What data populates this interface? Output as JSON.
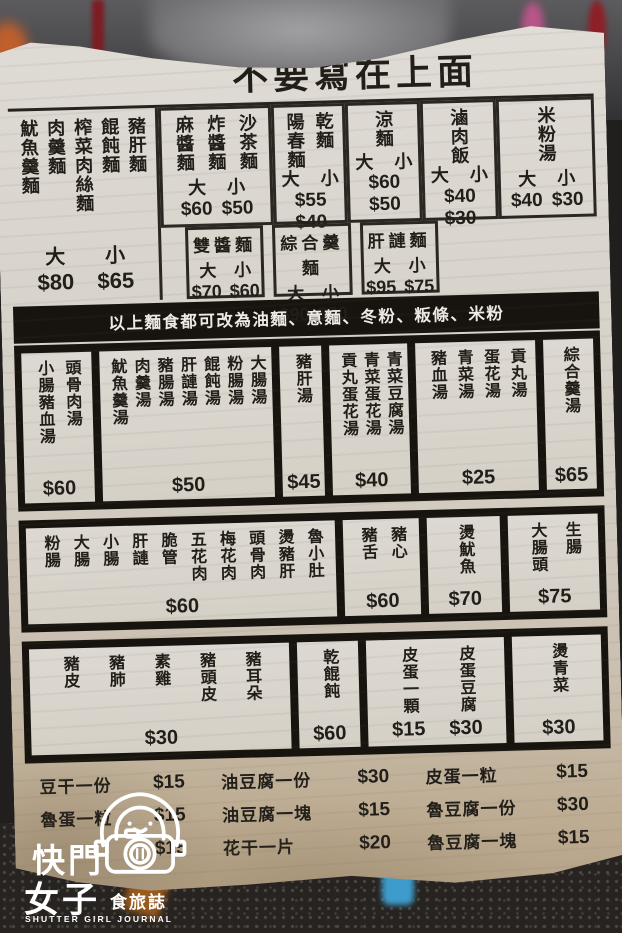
{
  "colors": {
    "paper": "#d7d2c9",
    "ink": "#211e19",
    "banner_bg": "#17130e",
    "watermark": "#ffffff"
  },
  "title": "不要寫在上面",
  "banner": "以上麵食都可改為油麵、意麵、冬粉、粄條、米粉",
  "noodles_left": {
    "items": [
      "魷魚羹麵",
      "肉羹麵",
      "榨菜肉絲麵",
      "餛飩麵",
      "豬肝麵"
    ],
    "size_large": "大",
    "price_large": "$80",
    "size_small": "小",
    "price_small": "$65"
  },
  "noodles_row1": [
    {
      "items": [
        "麻醬麵",
        "炸醬麵",
        "沙茶麵"
      ],
      "sizes": "大 小",
      "prices": "$60 $50"
    },
    {
      "items": [
        "陽春麵",
        "乾麵"
      ],
      "sizes": "大 小",
      "prices": "$55 $40"
    },
    {
      "items": [
        "涼麵"
      ],
      "sizes": "大 小",
      "prices": "$60 $50"
    },
    {
      "items": [
        "滷肉飯"
      ],
      "sizes": "大 小",
      "prices": "$40 $30"
    },
    {
      "items": [
        "米粉湯"
      ],
      "sizes": "大 小",
      "prices": "$40 $30"
    }
  ],
  "noodles_row2": [
    {
      "name": "雙醬麵",
      "sizes": "大 小",
      "prices": "$70 $60"
    },
    {
      "name": "綜合羹麵",
      "sizes": "大 小",
      "prices": "$90 $80"
    },
    {
      "name": "肝謰麵",
      "sizes": "大 小",
      "prices": "$95 $75"
    }
  ],
  "soups": [
    {
      "items": [
        "小腸豬血湯",
        "頭骨肉湯"
      ],
      "price": "$60"
    },
    {
      "items": [
        "魷魚羹湯",
        "肉羹湯",
        "豬腸湯",
        "肝謰湯",
        "餛飩湯",
        "粉腸湯",
        "大腸湯"
      ],
      "price": "$50"
    },
    {
      "items": [
        "豬肝湯"
      ],
      "price": "$45"
    },
    {
      "items": [
        "貢丸蛋花湯",
        "青菜蛋花湯",
        "青菜豆腐湯"
      ],
      "price": "$40"
    },
    {
      "items": [
        "豬血湯",
        "青菜湯",
        "蛋花湯",
        "貢丸湯"
      ],
      "price": "$25"
    },
    {
      "items": [
        "綜合羹湯"
      ],
      "price": "$65"
    }
  ],
  "braised": [
    {
      "items": [
        "粉腸",
        "大腸",
        "小腸",
        "肝謰",
        "脆管",
        "五花肉",
        "梅花肉",
        "頭骨肉",
        "燙豬肝",
        "魯小肚"
      ],
      "price": "$60"
    },
    {
      "items": [
        "豬舌",
        "豬心"
      ],
      "price": "$60"
    },
    {
      "items": [
        "燙魷魚"
      ],
      "price": "$70"
    },
    {
      "items": [
        "大腸頭",
        "生腸"
      ],
      "price": "$75"
    }
  ],
  "cold_cuts": {
    "cell1": {
      "items": [
        "豬皮",
        "豬肺",
        "素雞",
        "豬頭皮",
        "豬耳朵"
      ],
      "price": "$30"
    },
    "cell2": {
      "items": [
        "乾餛飩"
      ],
      "price": "$60"
    },
    "cell3": {
      "left": {
        "item": "皮蛋一顆",
        "price": "$15"
      },
      "right": {
        "item": "皮蛋豆腐",
        "price": "$30"
      }
    },
    "cell4": {
      "items": [
        "燙青菜"
      ],
      "price": "$30"
    }
  },
  "sides_rows": [
    [
      {
        "item": "豆干一份",
        "price": "$15"
      },
      {
        "item": "油豆腐一份",
        "price": "$30"
      },
      {
        "item": "皮蛋一粒",
        "price": "$15"
      }
    ],
    [
      {
        "item": "魯蛋一粒",
        "price": "$15"
      },
      {
        "item": "油豆腐一塊",
        "price": "$15"
      },
      {
        "item": "魯豆腐一份",
        "price": "$30"
      }
    ],
    [
      {
        "item": "",
        "price": "$15"
      },
      {
        "item": "花干一片",
        "price": "$20"
      },
      {
        "item": "魯豆腐一塊",
        "price": "$15"
      }
    ]
  ],
  "watermark": {
    "line1": "快門",
    "line2": "女子",
    "line3": "食旅誌",
    "line4": "SHUTTER GIRL JOURNAL"
  }
}
